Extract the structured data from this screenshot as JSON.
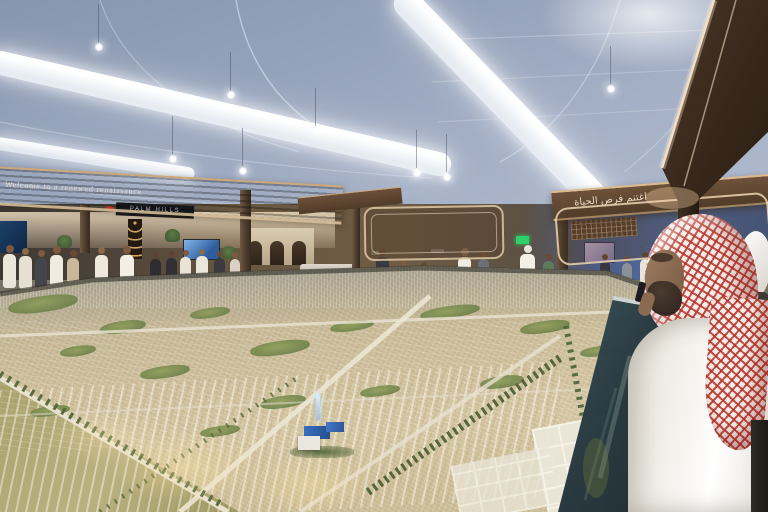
{
  "banners": {
    "left_text": "Welcome to a renewed renaissance",
    "right_text_arabic": "اغتنم فرص الحياة"
  },
  "signs": {
    "developer_sign": "PALM HILLS"
  },
  "palette": {
    "ceiling_blue": "#9aa8c0",
    "light_tube_white": "#f5f8fb",
    "fascia_brown": "#5d4531",
    "canopy_brown": "#3a2a1e",
    "model_base_tan": "#cfc19e",
    "model_green": "#7c8a4f",
    "model_road": "#e8e1cf",
    "mosque_roof_blue": "#2f62b0",
    "shemagh_red": "#ba3028",
    "thobe_white": "#f3f1ec",
    "railing_glass": "#2c3e42",
    "booth_wall_blue": "#4f6fa8",
    "exit_green": "#2ecf6a"
  }
}
